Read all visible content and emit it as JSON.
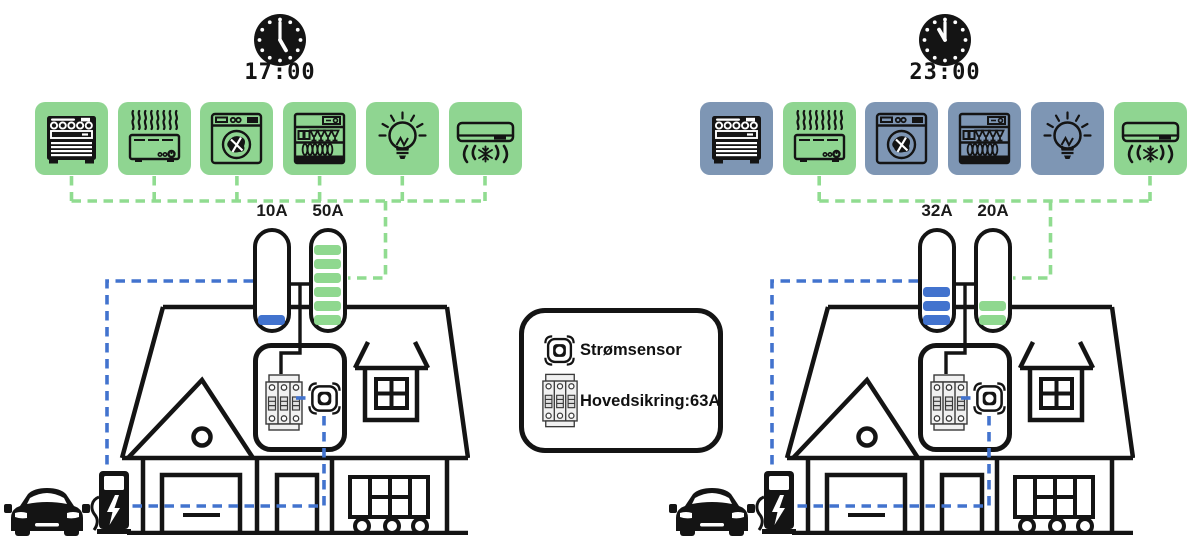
{
  "colors": {
    "active_tile_green": "#8FD591",
    "inactive_tile_blue": "#7E96B4",
    "segment_green": "#8FD88F",
    "accent_blue": "#4273CE",
    "wire_green": "#90DC90",
    "wire_blue": "#4273CE",
    "outline_black": "#141414"
  },
  "legend": {
    "items": [
      {
        "icon": "current-sensor-icon",
        "label": "Strømsensor"
      },
      {
        "icon": "main-fuse-icon",
        "label": "Hovedsikring:63A"
      }
    ]
  },
  "scenarios": [
    {
      "time": "17:00",
      "appliances": [
        {
          "name": "stove",
          "active": true
        },
        {
          "name": "heater",
          "active": true
        },
        {
          "name": "washing-machine",
          "active": true
        },
        {
          "name": "dishwasher",
          "active": true
        },
        {
          "name": "light-bulb",
          "active": true
        },
        {
          "name": "air-conditioner",
          "active": true
        }
      ],
      "gauges": [
        {
          "label": "10A",
          "filled_segments": 1,
          "max_segments": 6,
          "color": "blue"
        },
        {
          "label": "50A",
          "filled_segments": 6,
          "max_segments": 6,
          "color": "green"
        }
      ]
    },
    {
      "time": "23:00",
      "appliances": [
        {
          "name": "stove",
          "active": false
        },
        {
          "name": "heater",
          "active": true
        },
        {
          "name": "washing-machine",
          "active": false
        },
        {
          "name": "dishwasher",
          "active": false
        },
        {
          "name": "light-bulb",
          "active": false
        },
        {
          "name": "air-conditioner",
          "active": true
        }
      ],
      "gauges": [
        {
          "label": "32A",
          "filled_segments": 3,
          "max_segments": 6,
          "color": "blue"
        },
        {
          "label": "20A",
          "filled_segments": 2,
          "max_segments": 6,
          "color": "green"
        }
      ]
    }
  ]
}
